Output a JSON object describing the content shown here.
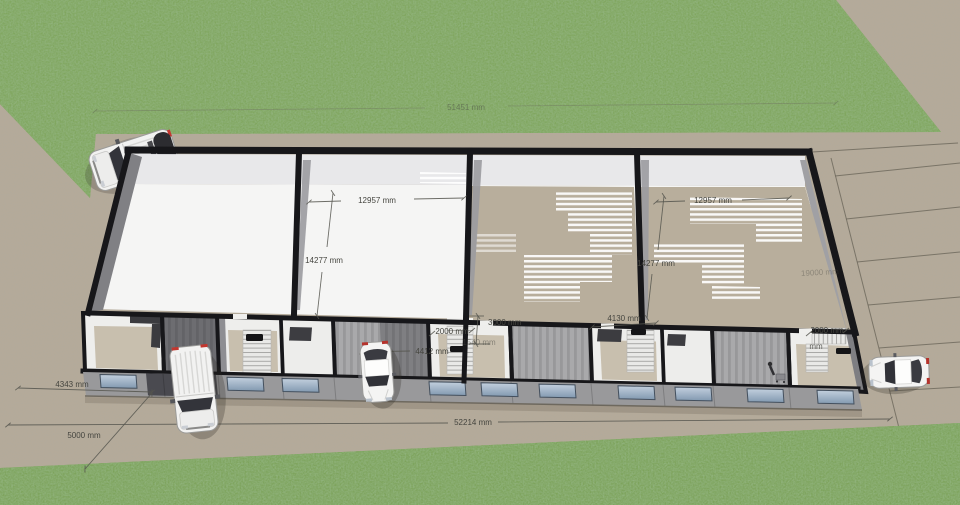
{
  "scene": {
    "type": "3d-site-plan-render",
    "units": "mm"
  },
  "dimensions": {
    "site": {
      "back_width": "51451 mm",
      "front_width": "52214 mm",
      "left_side": "4343 mm",
      "front_setback": "5000 mm",
      "right_depth": "19000 mm"
    },
    "halls": {
      "left_width": "12957 mm",
      "left_depth": "14277 mm",
      "right_width": "12957 mm",
      "right_depth": "14277 mm"
    },
    "front_units": {
      "entry_depth": "3000 mm",
      "lobby_a_width": "2000 mm",
      "lobby_a_unit_width": "4412 mm",
      "stair_run": "1540 mm",
      "lobby_b_width": "4130 mm",
      "lobby_c_width": "2000 mm",
      "lobby_c_partial": "mm"
    }
  },
  "colors": {
    "grass": "#7fa65d",
    "pavement": "#b4aa99",
    "wall_top": "#17171a",
    "hall_floor": "#f5f5f4",
    "bare_floor": "#b8ae9c",
    "facade": "#99999b",
    "window": "#a9bccd",
    "label": "#45453f"
  },
  "objects": {
    "vehicles": [
      "cargo-van",
      "cargo-van",
      "sedan",
      "sedan"
    ],
    "stair_lobbies": 4,
    "parking_bays": 6,
    "people": 1
  }
}
